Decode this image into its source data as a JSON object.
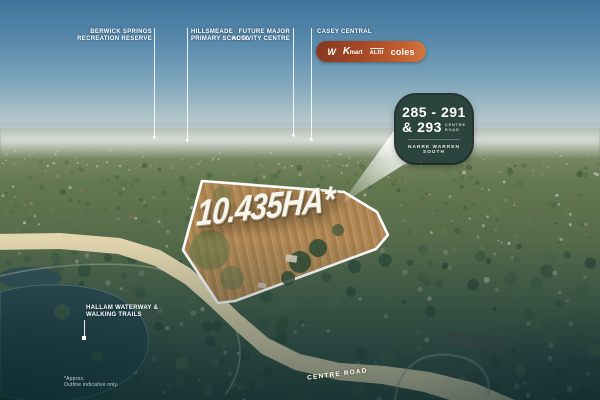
{
  "labels": {
    "berwick": {
      "line1": "BERWICK SPRINGS",
      "line2": "RECREATION RESERVE"
    },
    "hillsmeade": {
      "line1": "HILLSMEADE",
      "line2": "PRIMARY SCHOOL"
    },
    "future": {
      "line1": "FUTURE MAJOR",
      "line2": "ACTIVITY CENTRE"
    },
    "casey": {
      "line1": "CASEY CENTRAL"
    }
  },
  "retailers": {
    "woolworths_initial": "W",
    "kmart_initial": "K",
    "kmart_rest": "mart",
    "aldi": "ALDI",
    "coles": "coles"
  },
  "badge": {
    "numbers_line1": "285 - 291",
    "numbers_line2": "& 293",
    "road_line1": "CENTRE",
    "road_line2": "ROAD",
    "suburb": "NARRE WARREN SOUTH"
  },
  "site": {
    "area": "10.435HA*"
  },
  "map": {
    "waterway_line1": "HALLAM WATERWAY &",
    "waterway_line2": "WALKING TRAILS",
    "road_label": "CENTRE ROAD"
  },
  "disclaimer": {
    "line1": "*Approx.",
    "line2": "Outline indicative only."
  },
  "colors": {
    "badge_bg": "#2b453e",
    "pill_gradient_start": "#86381f",
    "pill_gradient_end": "#cd7a45",
    "site_outline": "#ffffff",
    "road_fill": "#e8dab2",
    "lake_fill": "#2d4a52"
  }
}
